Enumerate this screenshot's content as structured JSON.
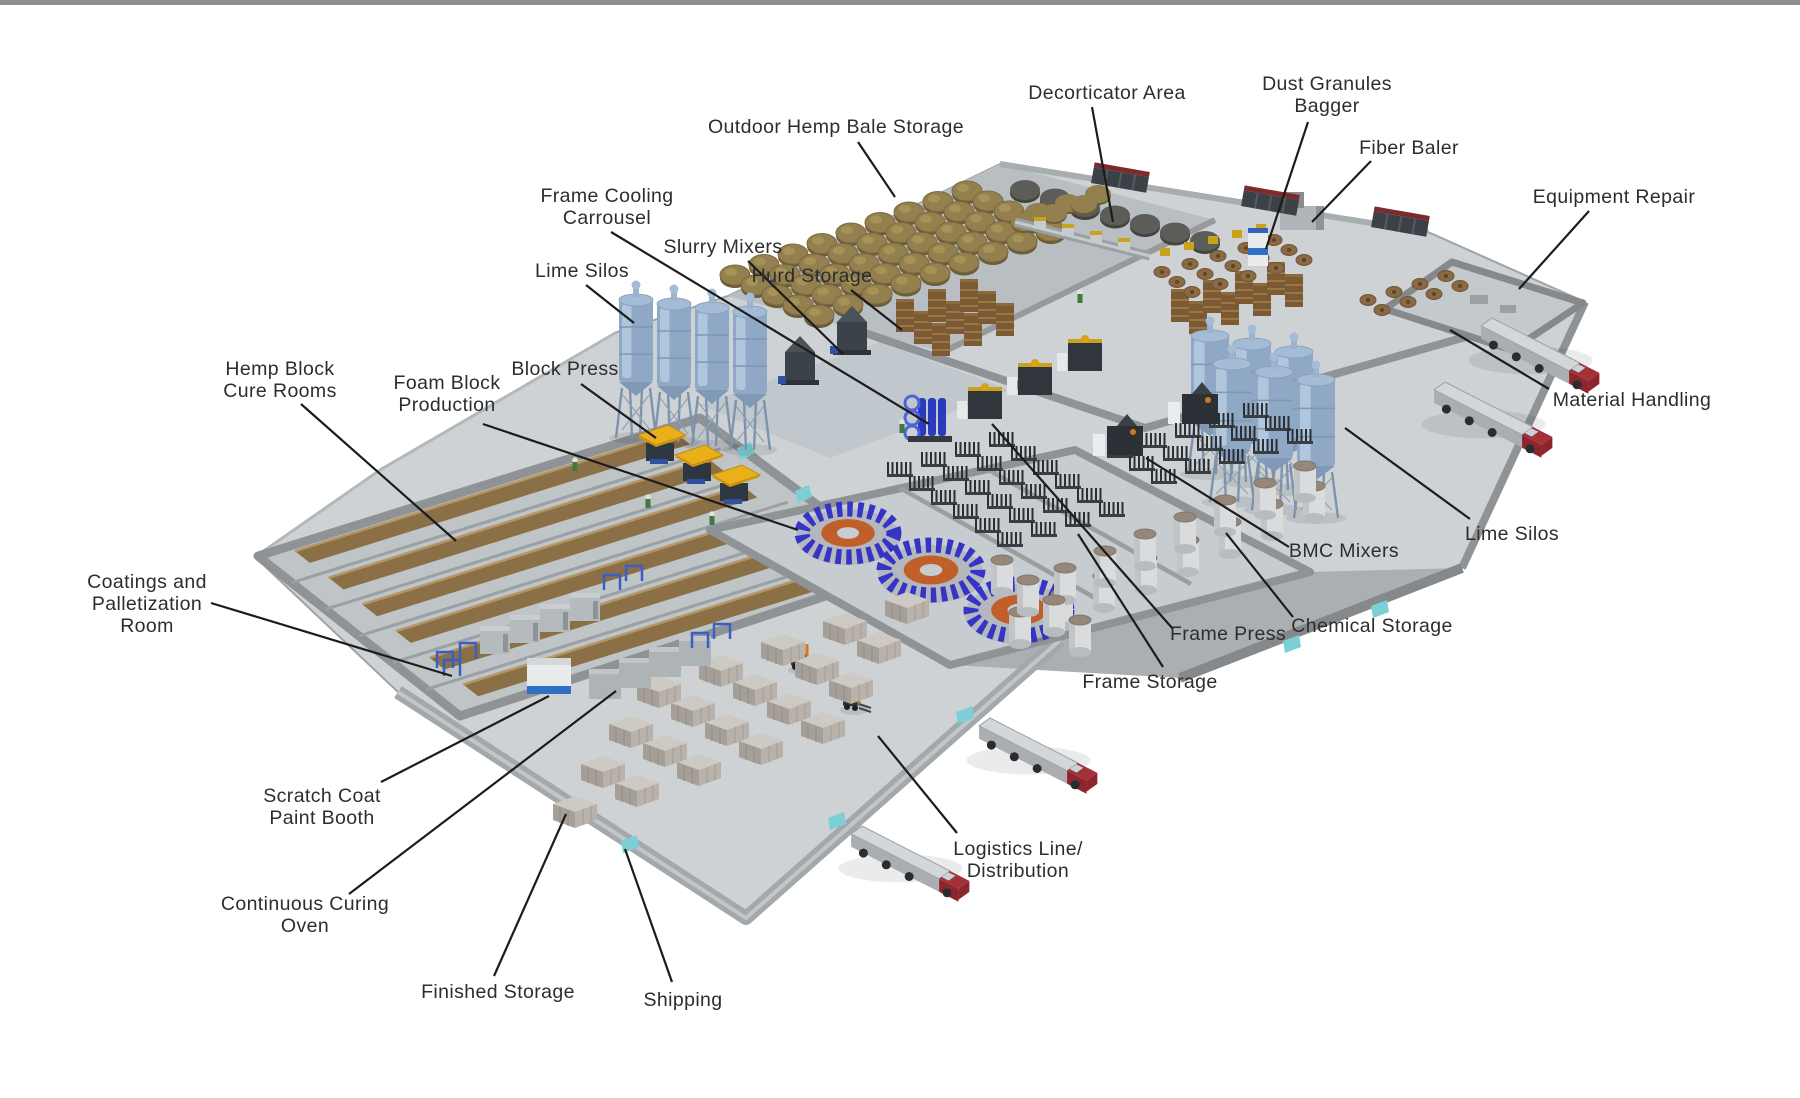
{
  "meta": {
    "top_bar_color": "#8e9092",
    "background_color": "#ffffff"
  },
  "diagram": {
    "description": "Isometric 3D factory floor plan of a hemp block production facility with labeled areas",
    "labels": [
      {
        "id": "outdoor-hemp-bale-storage",
        "lines": [
          "Outdoor Hemp Bale Storage"
        ],
        "x": 836,
        "y": 127,
        "leader": {
          "x1": 858,
          "y1": 142,
          "x2": 895,
          "y2": 197
        }
      },
      {
        "id": "decorticator-area",
        "lines": [
          "Decorticator Area"
        ],
        "x": 1107,
        "y": 93,
        "leader": {
          "x1": 1092,
          "y1": 107,
          "x2": 1113,
          "y2": 222
        }
      },
      {
        "id": "dust-granules-bagger",
        "lines": [
          "Dust Granules",
          "Bagger"
        ],
        "x": 1327,
        "y": 95,
        "leader": {
          "x1": 1308,
          "y1": 122,
          "x2": 1266,
          "y2": 249
        }
      },
      {
        "id": "fiber-baler",
        "lines": [
          "Fiber Baler"
        ],
        "x": 1409,
        "y": 148,
        "leader": {
          "x1": 1371,
          "y1": 161,
          "x2": 1312,
          "y2": 222
        }
      },
      {
        "id": "equipment-repair",
        "lines": [
          "Equipment Repair"
        ],
        "x": 1614,
        "y": 197,
        "leader": {
          "x1": 1589,
          "y1": 211,
          "x2": 1519,
          "y2": 289
        }
      },
      {
        "id": "frame-cooling-carrousel",
        "lines": [
          "Frame Cooling",
          "Carrousel"
        ],
        "x": 607,
        "y": 207,
        "leader": {
          "x1": 611,
          "y1": 232,
          "x2": 929,
          "y2": 424
        }
      },
      {
        "id": "slurry-mixers",
        "lines": [
          "Slurry Mixers"
        ],
        "x": 723,
        "y": 247,
        "leader": {
          "x1": 748,
          "y1": 261,
          "x2": 843,
          "y2": 354
        }
      },
      {
        "id": "hurd-storage",
        "lines": [
          "Hurd Storage"
        ],
        "x": 812,
        "y": 276,
        "leader": {
          "x1": 851,
          "y1": 290,
          "x2": 902,
          "y2": 330
        }
      },
      {
        "id": "lime-silos-left",
        "lines": [
          "Lime Silos"
        ],
        "x": 582,
        "y": 271,
        "leader": {
          "x1": 586,
          "y1": 285,
          "x2": 634,
          "y2": 323
        }
      },
      {
        "id": "block-press",
        "lines": [
          "Block Press"
        ],
        "x": 565,
        "y": 369,
        "leader": {
          "x1": 581,
          "y1": 384,
          "x2": 656,
          "y2": 438
        }
      },
      {
        "id": "hemp-block-cure-rooms",
        "lines": [
          "Hemp Block",
          "Cure Rooms"
        ],
        "x": 280,
        "y": 380,
        "leader": {
          "x1": 301,
          "y1": 404,
          "x2": 456,
          "y2": 541
        }
      },
      {
        "id": "foam-block-production",
        "lines": [
          "Foam Block",
          "Production"
        ],
        "x": 447,
        "y": 394,
        "leader": {
          "x1": 483,
          "y1": 424,
          "x2": 798,
          "y2": 530
        }
      },
      {
        "id": "material-handling",
        "lines": [
          "Material Handling"
        ],
        "x": 1632,
        "y": 400,
        "leader": {
          "x1": 1549,
          "y1": 389,
          "x2": 1450,
          "y2": 330
        }
      },
      {
        "id": "lime-silos-right",
        "lines": [
          "Lime Silos"
        ],
        "x": 1512,
        "y": 534,
        "leader": {
          "x1": 1470,
          "y1": 519,
          "x2": 1345,
          "y2": 428
        }
      },
      {
        "id": "bmc-mixers",
        "lines": [
          "BMC Mixers"
        ],
        "x": 1344,
        "y": 551,
        "leader": {
          "x1": 1289,
          "y1": 547,
          "x2": 1146,
          "y2": 458
        }
      },
      {
        "id": "chemical-storage",
        "lines": [
          "Chemical Storage"
        ],
        "x": 1372,
        "y": 626,
        "leader": {
          "x1": 1293,
          "y1": 617,
          "x2": 1226,
          "y2": 533
        }
      },
      {
        "id": "frame-press",
        "lines": [
          "Frame Press"
        ],
        "x": 1228,
        "y": 634,
        "leader": {
          "x1": 1173,
          "y1": 629,
          "x2": 992,
          "y2": 424
        }
      },
      {
        "id": "frame-storage",
        "lines": [
          "Frame Storage"
        ],
        "x": 1150,
        "y": 682,
        "leader": {
          "x1": 1163,
          "y1": 667,
          "x2": 1078,
          "y2": 534
        }
      },
      {
        "id": "coatings-and-palletization-room",
        "lines": [
          "Coatings and",
          "Palletization",
          "Room"
        ],
        "x": 147,
        "y": 604,
        "leader": {
          "x1": 211,
          "y1": 603,
          "x2": 452,
          "y2": 676
        }
      },
      {
        "id": "scratch-coat-paint-booth",
        "lines": [
          "Scratch Coat",
          "Paint Booth"
        ],
        "x": 322,
        "y": 807,
        "leader": {
          "x1": 381,
          "y1": 782,
          "x2": 549,
          "y2": 696
        }
      },
      {
        "id": "continuous-curing-oven",
        "lines": [
          "Continuous Curing",
          "Oven"
        ],
        "x": 305,
        "y": 915,
        "leader": {
          "x1": 349,
          "y1": 894,
          "x2": 616,
          "y2": 691
        }
      },
      {
        "id": "finished-storage",
        "lines": [
          "Finished Storage"
        ],
        "x": 498,
        "y": 992,
        "leader": {
          "x1": 494,
          "y1": 976,
          "x2": 566,
          "y2": 814
        }
      },
      {
        "id": "shipping",
        "lines": [
          "Shipping"
        ],
        "x": 683,
        "y": 1000,
        "leader": {
          "x1": 672,
          "y1": 982,
          "x2": 625,
          "y2": 849
        }
      },
      {
        "id": "logistics-line-distribution",
        "lines": [
          "Logistics Line/",
          "Distribution"
        ],
        "x": 1018,
        "y": 860,
        "leader": {
          "x1": 957,
          "y1": 833,
          "x2": 878,
          "y2": 736
        }
      }
    ]
  },
  "scene": {
    "colors": {
      "floor": "#ced2d5",
      "floor_dark": "#b9bec2",
      "floor_tile": "#b4bdc6",
      "corridor": "#aaafb3",
      "wall": "#8f9396",
      "wall_dark": "#85898c",
      "wall_light": "#a8adb0",
      "curb": "#b3b8bb",
      "bale": "#93804e",
      "bale_dark": "#6c5d3a",
      "tarp_bale": "#5c5c58",
      "hurd": "#7c5a34",
      "hurd_stripe": "#9a7748",
      "silo": "#8ea8c6",
      "silo_light": "#b6cbdf",
      "silo_trim": "#7d97b5",
      "silo_leg": "#7d93ab",
      "yellow_machine": "#e9b01c",
      "machine_dark": "#33383e",
      "machine_base": "#2e3640",
      "carousel_blue": "#3534c6",
      "carousel_orange": "#c05f2a",
      "pipe_blue": "#2b3bbd",
      "accent_blue": "#2f6fc4",
      "frame_blue": "#3a5fc4",
      "teal_door": "#7ccfd4",
      "red_top": "#7c2a2c",
      "truck_cab": "#8c262c",
      "truck_cab_top": "#a23238",
      "truck_trailer_top": "#d4d7da",
      "truck_trailer_side": "#aaaeb2",
      "cylinder": "#d9dbdd",
      "cylinder_top": "#958779",
      "stack_top": "#cdc9c3",
      "stack_front": "#a59f97",
      "stack_side": "#b8b2aa",
      "cure_stack": "#8a6f47",
      "cure_stack_top": "#b49563",
      "forklift_orange": "#d2771e",
      "worker_green": "#3f7a3f",
      "label_ink": "#2d2d2d",
      "leader": "#1c1c1c"
    }
  }
}
